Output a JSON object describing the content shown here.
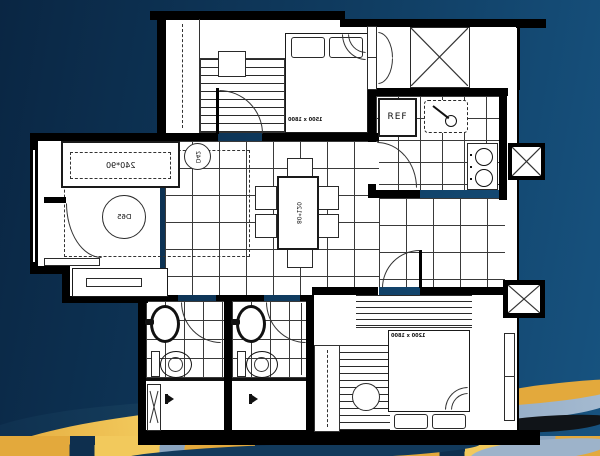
{
  "scene": {
    "description": "Mirrored apartment floor plan over navy background with painted gold landscape strokes at bottom",
    "colors": {
      "background_left": "#0a2643",
      "background_right": "#175380",
      "wall": "#000000",
      "floor": "#ffffff",
      "line": "#333333",
      "paint_gold": "#e3a93c",
      "paint_light_gold": "#f2c95c",
      "paint_steel_blue": "#8ba5c0",
      "paint_navy": "#0e2f4e",
      "paint_black": "#101418"
    }
  },
  "floorplan": {
    "labels": {
      "sofa_dim": "240*90",
      "coffee_table_dia": "D65",
      "side_table_dia": "D42",
      "dining_table_dim": "80*120",
      "fridge": "REF",
      "bed_master_dim": "1500 x 1800",
      "bed_second_dim": "1200 x 1800"
    },
    "icons": {
      "shaft": "x-cross-box",
      "stove": "two-burner-hob",
      "kitchen_sink": "sink-with-faucet",
      "bath_sink": "oval-basin",
      "toilet": "toilet-bowl",
      "shower": "shower-head",
      "door": "quarter-arc-swing"
    }
  }
}
